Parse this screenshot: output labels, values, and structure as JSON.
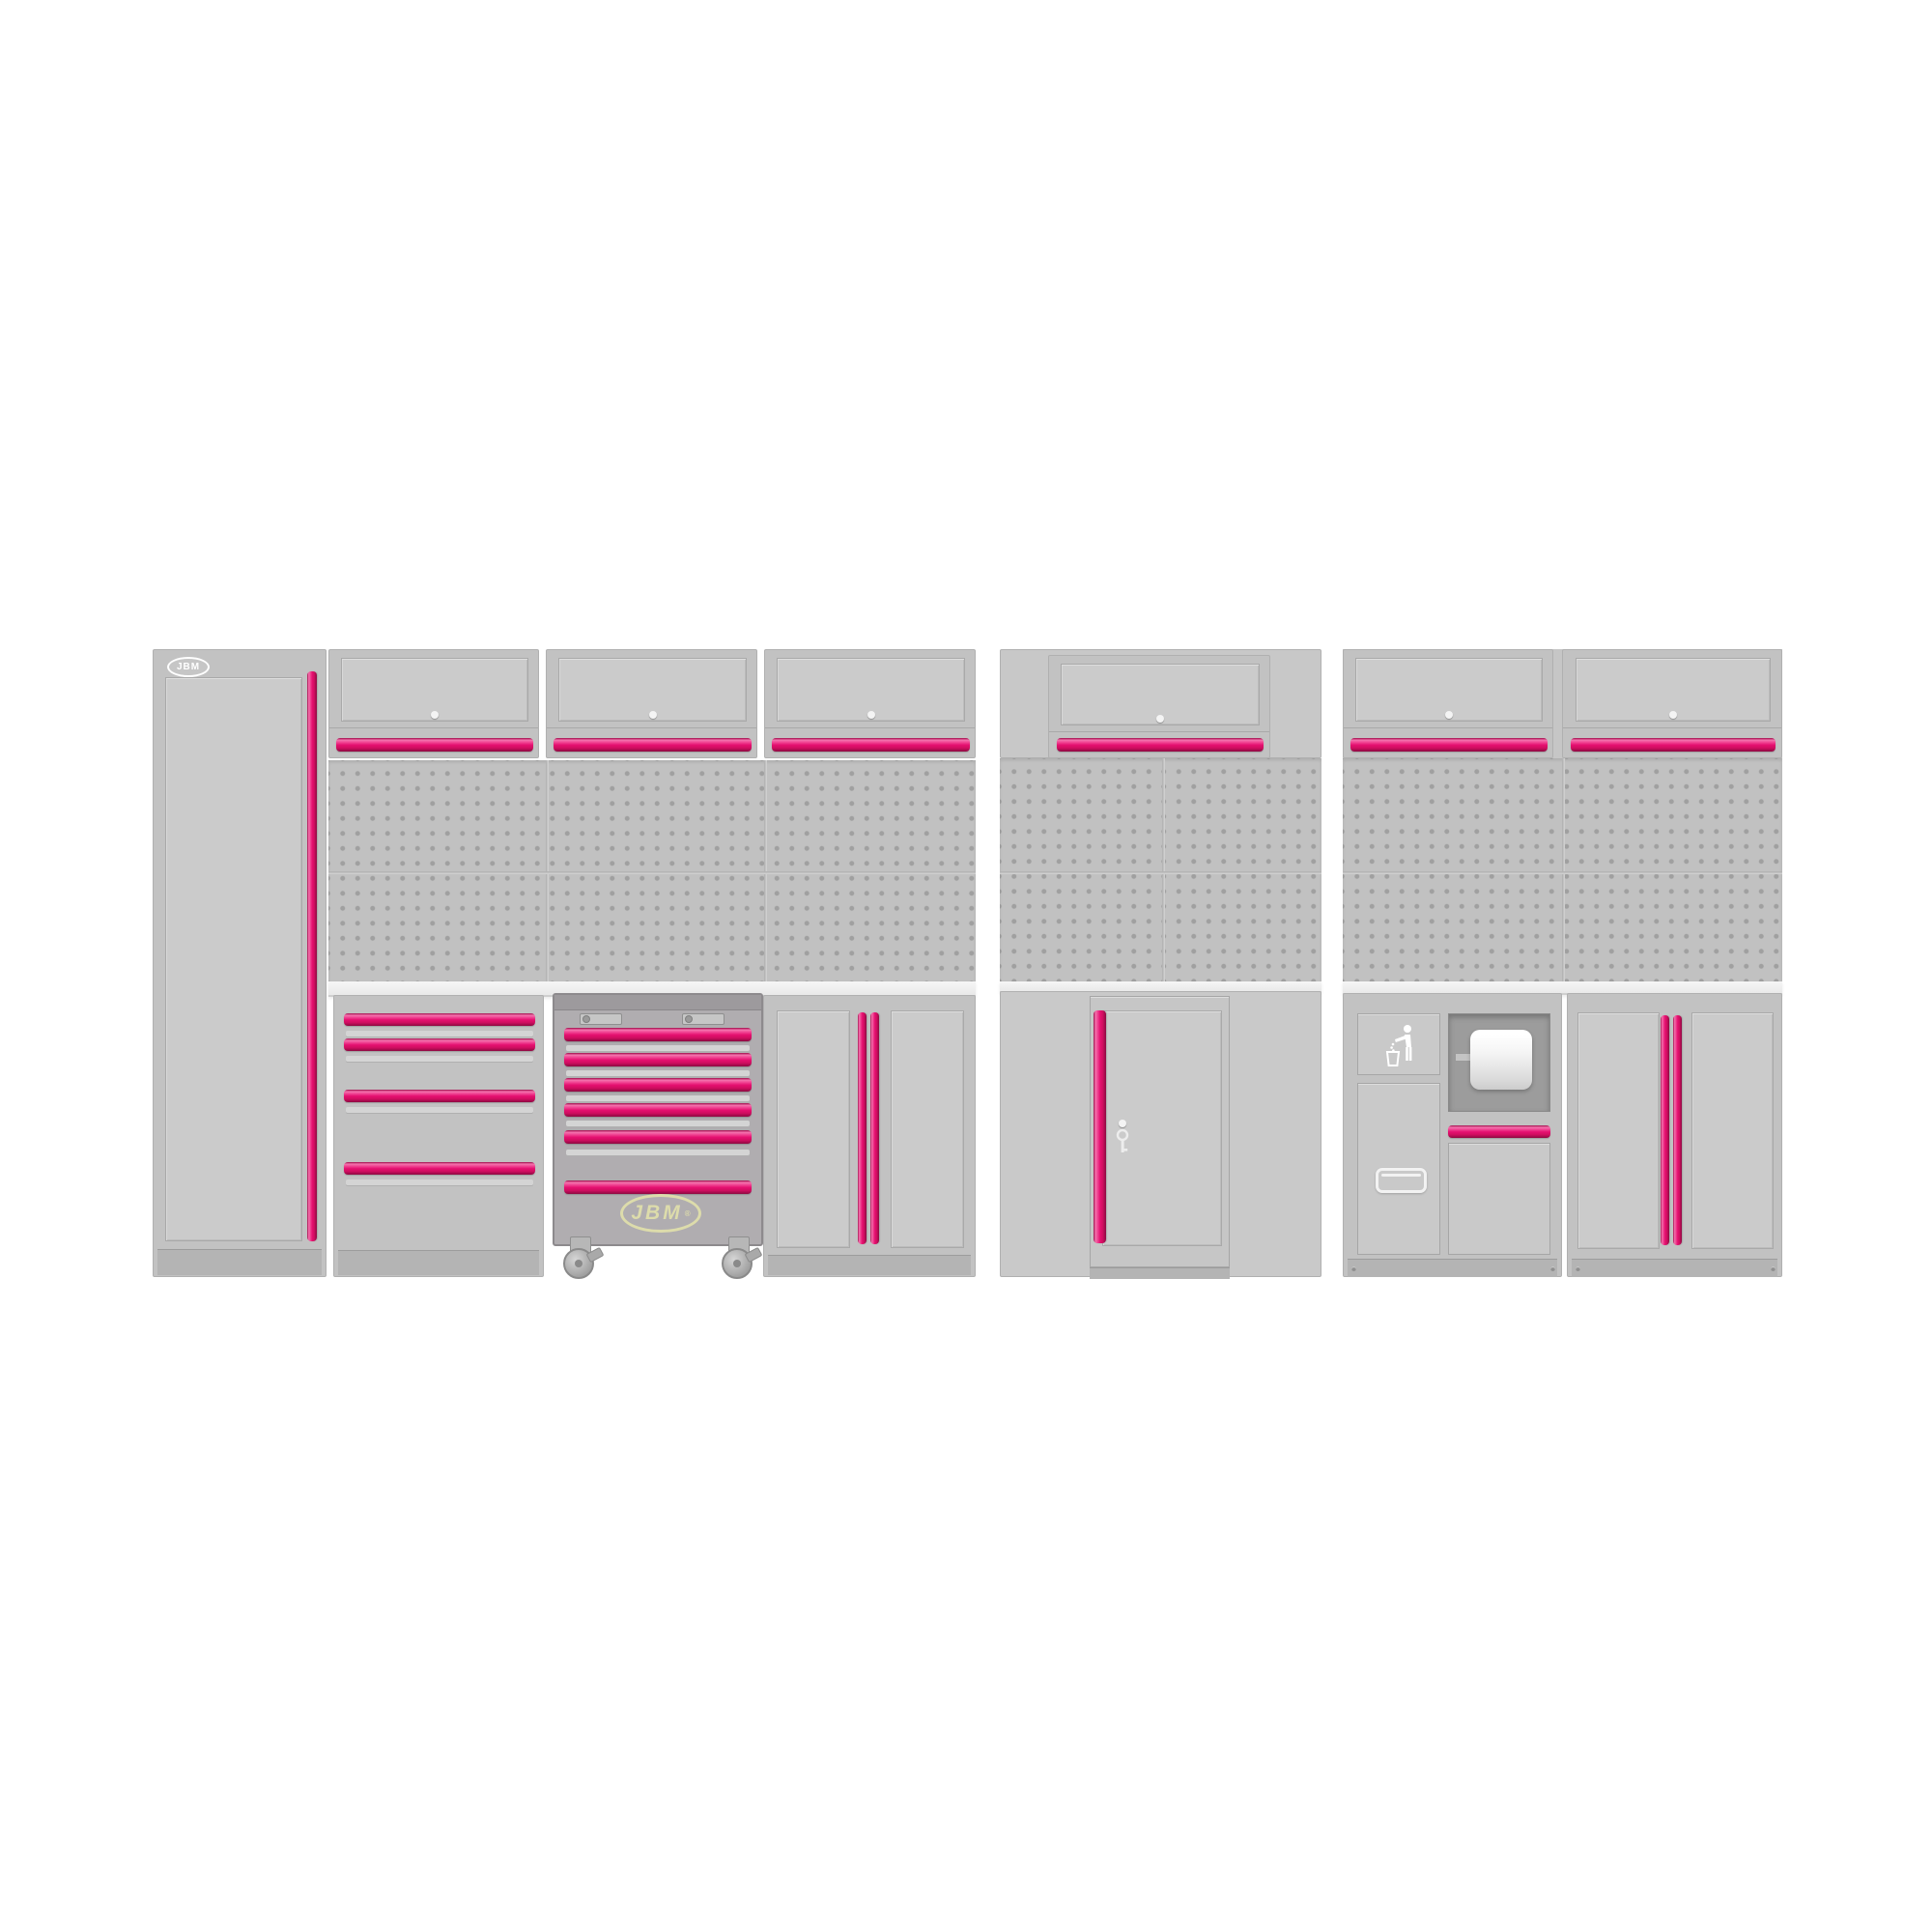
{
  "page": {
    "background": "#ffffff",
    "description": "JBM modular workshop cabinet wall system product render, three groups of ghosted grey cabinets with magenta handles; the six-drawer roller tool trolley is the highlighted product"
  },
  "branding": {
    "locker_badge_text": "JBM",
    "trolley_logo_text": "JBM",
    "trolley_logo_reg": "®"
  },
  "theme": {
    "page_bg": "#ffffff",
    "accent_pink": "#e51070",
    "accent_pink_bright": "#f373ad",
    "accent_pink_deep": "#8c0941",
    "ghost_grey": "#c2c2c2",
    "pegboard_grey": "#c1c1c1",
    "pegboard_hole": "#a0a0a0",
    "trolley_grey": "#b0adb0",
    "trolley_outline": "#8d8a8d",
    "logo_olive": "#dddcab",
    "worktop_white": "#f6f6f6",
    "opening_grey": "#9c9c9c",
    "icon_white": "#ffffff"
  },
  "scene": {
    "left_section": {
      "units": [
        "tall-locker-with-badge",
        "wall-flip-cabinet",
        "wall-flip-cabinet",
        "wall-flip-cabinet",
        "pegboard-wall",
        "worktop",
        "four-drawer-base-cabinet",
        "six-drawer-roller-trolley",
        "double-door-base-cabinet"
      ]
    },
    "middle_section": {
      "units": [
        "wall-flip-cabinet",
        "pegboard-wall",
        "single-door-cabinet-with-key"
      ]
    },
    "right_section": {
      "units": [
        "wall-flip-cabinet",
        "wall-flip-cabinet",
        "pegboard-wall",
        "worktop",
        "waste-and-paper-roll-station",
        "double-door-base-cabinet"
      ]
    },
    "drawer_counts": {
      "base_drawer_cabinet": 4,
      "roller_trolley": 6
    },
    "caster_count_visible": 2
  }
}
